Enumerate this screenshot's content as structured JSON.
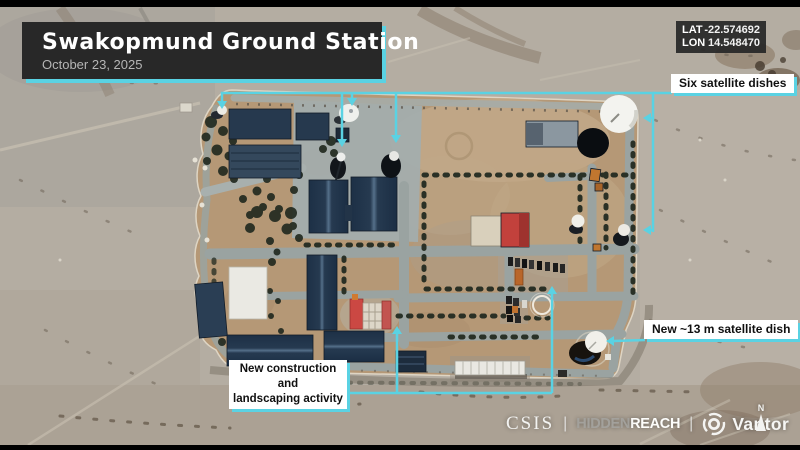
{
  "header": {
    "title": "Swakopmund Ground Station",
    "date": "October 23, 2025"
  },
  "coordinates": {
    "lat_label": "LAT",
    "lat_value": "-22.574692",
    "lon_label": "LON",
    "lon_value": "14.548470"
  },
  "callouts": {
    "six_dishes": "Six satellite dishes",
    "new_dish": "New ~13 m satellite dish",
    "construction": [
      "New construction and",
      "landscaping activity"
    ]
  },
  "footer": {
    "csis": "CSIS",
    "separator": "|",
    "hidden": "HIDDEN",
    "reach": "REACH",
    "vantor": "Vantor",
    "north_label": "N"
  },
  "colors": {
    "accent": "#5ad2e3",
    "card_bg": "#282828",
    "label_bg": "#ffffff",
    "label_text": "#101010"
  },
  "icons": {
    "vantor": "vantor-rings-icon",
    "north": "north-arrow-icon"
  }
}
